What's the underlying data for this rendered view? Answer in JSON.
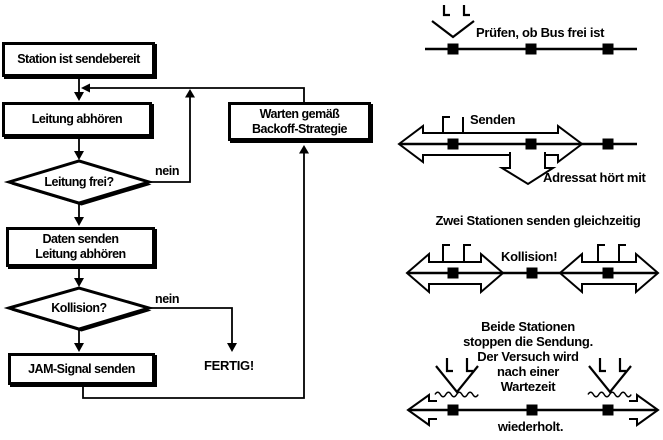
{
  "colors": {
    "ink": "#000000",
    "paper": "#ffffff"
  },
  "flowchart": {
    "start_box": "Station ist sendebereit",
    "listen_box": "Leitung abhören",
    "decision_free": "Leitung frei?",
    "send_box_line1": "Daten senden",
    "send_box_line2": "Leitung abhören",
    "decision_collision": "Kollision?",
    "jam_box": "JAM-Signal senden",
    "backoff_box_line1": "Warten gemäß",
    "backoff_box_line2": "Backoff-Strategie",
    "label_nein_free": "nein",
    "label_nein_collision": "nein",
    "label_done": "FERTIG!"
  },
  "illustrations": {
    "check_caption": "Prüfen, ob Bus frei ist",
    "send_caption": "Senden",
    "receive_caption": "Adressat hört mit",
    "collision_title": "Zwei Stationen senden gleichzeitig",
    "collision_caption": "Kollision!",
    "backoff_line1": "Beide Stationen",
    "backoff_line2": "stoppen die Sendung.",
    "backoff_line3": "Der Versuch wird",
    "backoff_line4": "nach einer",
    "backoff_line5": "Wartezeit",
    "backoff_caption": "wiederholt."
  }
}
